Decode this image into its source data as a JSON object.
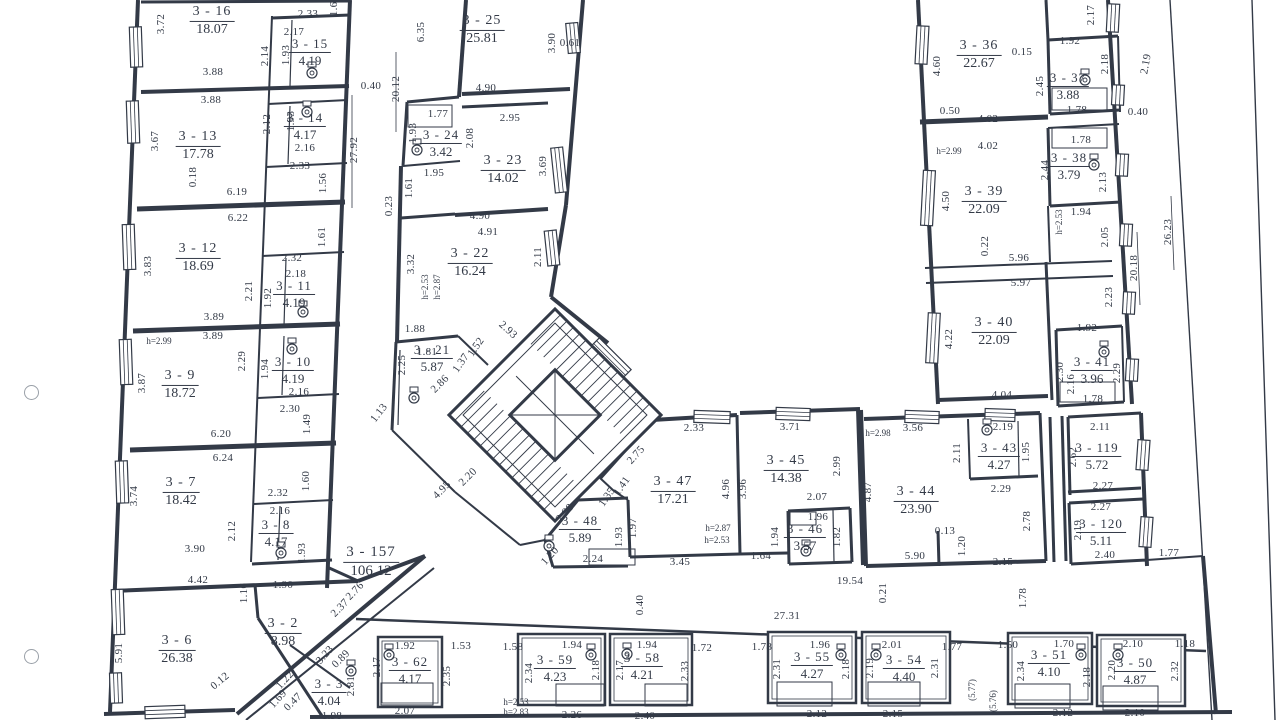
{
  "palette": {
    "ink": "#333a47",
    "paper": "#ffffff"
  },
  "drawing": {
    "type": "floor-plan",
    "rooms": [
      [
        "3 - 16",
        "18.07",
        212,
        21,
        14
      ],
      [
        "3 - 15",
        "4.19",
        310,
        52,
        13
      ],
      [
        "3 - 13",
        "17.78",
        198,
        146,
        14
      ],
      [
        "3 - 14",
        "4.17",
        305,
        126,
        13
      ],
      [
        "3 - 12",
        "18.69",
        198,
        258,
        14
      ],
      [
        "3 - 11",
        "4.19",
        294,
        294,
        13
      ],
      [
        "3 - 9",
        "18.72",
        180,
        385,
        14
      ],
      [
        "3 - 10",
        "4.19",
        293,
        370,
        13
      ],
      [
        "3 - 7",
        "18.42",
        181,
        492,
        14
      ],
      [
        "3 - 8",
        "4.17",
        276,
        533,
        13
      ],
      [
        "3 - 6",
        "26.38",
        177,
        650,
        14
      ],
      [
        "3 - 2",
        "8.98",
        283,
        633,
        14
      ],
      [
        "3 - 3",
        "4.04",
        329,
        692,
        13
      ],
      [
        "3 - 157",
        "106.12",
        371,
        562,
        15
      ],
      [
        "3 - 25",
        "25.81",
        482,
        30,
        14
      ],
      [
        "3 - 24",
        "3.42",
        441,
        143,
        13
      ],
      [
        "3 - 23",
        "14.02",
        503,
        170,
        14
      ],
      [
        "3 - 22",
        "16.24",
        470,
        263,
        14
      ],
      [
        "3 - 21",
        "5.87",
        432,
        358,
        13
      ],
      [
        "3 - 36",
        "22.67",
        979,
        55,
        14
      ],
      [
        "3 - 37",
        "3.88",
        1068,
        86,
        13
      ],
      [
        "3 - 38",
        "3.79",
        1069,
        166,
        13
      ],
      [
        "3 - 39",
        "22.09",
        984,
        201,
        14
      ],
      [
        "3 - 40",
        "22.09",
        994,
        332,
        14
      ],
      [
        "3 - 41",
        "3.96",
        1092,
        370,
        13
      ],
      [
        "3 - 47",
        "17.21",
        673,
        491,
        14
      ],
      [
        "3 - 45",
        "14.38",
        786,
        470,
        14
      ],
      [
        "3 - 48",
        "5.89",
        580,
        529,
        13
      ],
      [
        "3 - 46",
        "3.57",
        805,
        537,
        13
      ],
      [
        "3 - 44",
        "23.90",
        916,
        501,
        14
      ],
      [
        "3 - 43",
        "4.27",
        999,
        456,
        13
      ],
      [
        "3 - 119",
        "5.72",
        1097,
        456,
        13
      ],
      [
        "3 - 120",
        "5.11",
        1101,
        532,
        13
      ],
      [
        "3 - 62",
        "4.17",
        410,
        670,
        13
      ],
      [
        "3 - 59",
        "4.23",
        555,
        668,
        13
      ],
      [
        "3 - 58",
        "4.21",
        642,
        666,
        13
      ],
      [
        "3 - 55",
        "4.27",
        812,
        665,
        13
      ],
      [
        "3 - 54",
        "4.40",
        904,
        668,
        13
      ],
      [
        "3 - 51",
        "4.10",
        1049,
        663,
        13
      ],
      [
        "3 - 50",
        "4.87",
        1135,
        671,
        13
      ]
    ],
    "dims": [
      [
        "3.72",
        161,
        24,
        -90
      ],
      [
        "1.61",
        334,
        6,
        -90
      ],
      [
        "2.33",
        308,
        14,
        0
      ],
      [
        "2.17",
        294,
        32,
        0
      ],
      [
        "2.14",
        265,
        56,
        -90
      ],
      [
        "1.93",
        286,
        55,
        -90
      ],
      [
        "3.88",
        213,
        72,
        0
      ],
      [
        "3.88",
        211,
        100,
        0
      ],
      [
        "1.93",
        291,
        121,
        -90
      ],
      [
        "2.12",
        267,
        124,
        -90
      ],
      [
        "3.67",
        155,
        141,
        -90
      ],
      [
        "2.16",
        305,
        148,
        0
      ],
      [
        "2.33",
        300,
        166,
        0
      ],
      [
        "1.56",
        323,
        183,
        -90
      ],
      [
        "0.18",
        193,
        177,
        -90
      ],
      [
        "6.19",
        237,
        192,
        0
      ],
      [
        "0.40",
        371,
        86,
        0
      ],
      [
        "27.92",
        354,
        150,
        -90
      ],
      [
        "20.12",
        396,
        89,
        -90
      ],
      [
        "6.35",
        421,
        32,
        -90
      ],
      [
        "4.90",
        486,
        88,
        0
      ],
      [
        "3.90",
        552,
        43,
        -90
      ],
      [
        "0.61",
        570,
        43,
        0
      ],
      [
        "1.77",
        438,
        114,
        0
      ],
      [
        "1.93",
        413,
        133,
        -90
      ],
      [
        "2.08",
        470,
        138,
        -90
      ],
      [
        "2.95",
        510,
        118,
        0
      ],
      [
        "3.69",
        543,
        166,
        -90
      ],
      [
        "1.95",
        434,
        173,
        0
      ],
      [
        "1.61",
        409,
        188,
        -90
      ],
      [
        "0.23",
        389,
        206,
        -90
      ],
      [
        "6.22",
        238,
        218,
        0
      ],
      [
        "1.61",
        322,
        237,
        -90
      ],
      [
        "3.83",
        148,
        266,
        -90
      ],
      [
        "2.32",
        292,
        258,
        0
      ],
      [
        "2.18",
        296,
        274,
        0
      ],
      [
        "2.21",
        249,
        291,
        -90
      ],
      [
        "1.92",
        268,
        298,
        -90
      ],
      [
        "3.89",
        214,
        317,
        0
      ],
      [
        "3.89",
        213,
        336,
        0
      ],
      [
        "h=2.99",
        159,
        341,
        0
      ],
      [
        "2.29",
        242,
        361,
        -90
      ],
      [
        "1.94",
        265,
        369,
        -90
      ],
      [
        "3.87",
        142,
        383,
        -90
      ],
      [
        "2.16",
        299,
        392,
        0
      ],
      [
        "2.30",
        290,
        409,
        0
      ],
      [
        "1.49",
        307,
        424,
        -90
      ],
      [
        "6.20",
        221,
        434,
        0
      ],
      [
        "6.24",
        223,
        458,
        0
      ],
      [
        "3.74",
        134,
        496,
        -90
      ],
      [
        "1.60",
        306,
        481,
        -90
      ],
      [
        "2.32",
        278,
        493,
        0
      ],
      [
        "2.16",
        280,
        511,
        0
      ],
      [
        "2.12",
        232,
        531,
        -90
      ],
      [
        "3.90",
        195,
        549,
        0
      ],
      [
        "1.93",
        302,
        553,
        -90
      ],
      [
        "4.42",
        198,
        580,
        0
      ],
      [
        "1.90",
        283,
        585,
        0
      ],
      [
        "1.16",
        244,
        593,
        -90
      ],
      [
        "5.91",
        119,
        653,
        -90
      ],
      [
        "2.76",
        355,
        591,
        -46
      ],
      [
        "2.37",
        340,
        608,
        -46
      ],
      [
        "0.12",
        220,
        681,
        -40
      ],
      [
        "3.23",
        325,
        655,
        -48
      ],
      [
        "1.22",
        285,
        680,
        -48
      ],
      [
        "1.69",
        278,
        699,
        -48
      ],
      [
        "0.89",
        341,
        659,
        -45
      ],
      [
        "0.47",
        293,
        702,
        -45
      ],
      [
        "2.81",
        351,
        686,
        -90
      ],
      [
        "1.98",
        332,
        716,
        0
      ],
      [
        "4.90",
        480,
        216,
        0
      ],
      [
        "4.91",
        488,
        232,
        0
      ],
      [
        "3.32",
        411,
        264,
        -90
      ],
      [
        "2.11",
        538,
        257,
        -90
      ],
      [
        "h=2.53",
        425,
        287,
        -90
      ],
      [
        "h=2.87",
        437,
        287,
        -90
      ],
      [
        "1.88",
        415,
        329,
        0
      ],
      [
        "1.81",
        427,
        352,
        0
      ],
      [
        "2.93",
        508,
        330,
        42
      ],
      [
        "1.52",
        476,
        347,
        -55
      ],
      [
        "1.37",
        461,
        363,
        -55
      ],
      [
        "2.25",
        402,
        365,
        -90
      ],
      [
        "2.86",
        440,
        384,
        -45
      ],
      [
        "1.13",
        379,
        413,
        -52
      ],
      [
        "2.20",
        468,
        477,
        -45
      ],
      [
        "4.95",
        442,
        490,
        -45
      ],
      [
        "2.33",
        694,
        428,
        0
      ],
      [
        "2.75",
        636,
        455,
        -48
      ],
      [
        "1.41",
        622,
        486,
        -55
      ],
      [
        "1.35",
        607,
        497,
        -55
      ],
      [
        "3.71",
        790,
        427,
        0
      ],
      [
        "2.99",
        837,
        466,
        -90
      ],
      [
        "4.96",
        726,
        489,
        -90
      ],
      [
        "3.96",
        743,
        489,
        -90
      ],
      [
        "2.07",
        817,
        497,
        0
      ],
      [
        "h=2.87",
        718,
        528,
        0
      ],
      [
        "h=2.53",
        717,
        540,
        0
      ],
      [
        "1.96",
        818,
        517,
        0
      ],
      [
        "1.94",
        775,
        537,
        -90
      ],
      [
        "1.82",
        837,
        537,
        -90
      ],
      [
        "1.64",
        761,
        556,
        0
      ],
      [
        "3.45",
        680,
        562,
        0
      ],
      [
        "1.97",
        633,
        528,
        -90
      ],
      [
        "1.93",
        619,
        537,
        -90
      ],
      [
        "2.24",
        593,
        559,
        0
      ],
      [
        "1.20",
        550,
        556,
        -48
      ],
      [
        "2.98",
        565,
        513,
        -48
      ],
      [
        "19.54",
        850,
        581,
        0
      ],
      [
        "0.21",
        883,
        593,
        -90
      ],
      [
        "0.40",
        640,
        605,
        -90
      ],
      [
        "27.31",
        787,
        616,
        0
      ],
      [
        "4.60",
        937,
        66,
        -90
      ],
      [
        "0.15",
        1022,
        52,
        0
      ],
      [
        "1.92",
        1070,
        41,
        0
      ],
      [
        "2.17",
        1091,
        15,
        -90
      ],
      [
        "2.45",
        1040,
        86,
        -90
      ],
      [
        "2.18",
        1105,
        64,
        -90
      ],
      [
        "2.19",
        1146,
        64,
        -80
      ],
      [
        "0.50",
        950,
        111,
        0
      ],
      [
        "4.02",
        988,
        119,
        0
      ],
      [
        "4.02",
        988,
        146,
        0
      ],
      [
        "h=2.99",
        949,
        151,
        0
      ],
      [
        "1.78",
        1077,
        110,
        0
      ],
      [
        "1.78",
        1081,
        140,
        0
      ],
      [
        "2.44",
        1045,
        170,
        -90
      ],
      [
        "2.13",
        1103,
        182,
        -90
      ],
      [
        "1.94",
        1081,
        212,
        0
      ],
      [
        "h=2.53",
        1059,
        222,
        -90
      ],
      [
        "2.05",
        1105,
        237,
        -90
      ],
      [
        "4.50",
        946,
        201,
        -90
      ],
      [
        "0.22",
        985,
        246,
        -90
      ],
      [
        "5.96",
        1019,
        258,
        0
      ],
      [
        "5.97",
        1021,
        283,
        0
      ],
      [
        "2.23",
        1109,
        297,
        -90
      ],
      [
        "20.18",
        1134,
        268,
        -90
      ],
      [
        "26.23",
        1168,
        232,
        -90
      ],
      [
        "0.40",
        1138,
        112,
        0
      ],
      [
        "4.22",
        949,
        339,
        -90
      ],
      [
        "1.92",
        1087,
        328,
        0
      ],
      [
        "2.30",
        1060,
        372,
        -90
      ],
      [
        "2.16",
        1071,
        384,
        -90
      ],
      [
        "2.29",
        1117,
        373,
        -90
      ],
      [
        "1.78",
        1093,
        399,
        0
      ],
      [
        "4.04",
        1002,
        395,
        0
      ],
      [
        "3.56",
        913,
        428,
        0
      ],
      [
        "h=2.98",
        878,
        433,
        0
      ],
      [
        "2.11",
        957,
        453,
        -90
      ],
      [
        "2.19",
        1003,
        427,
        0
      ],
      [
        "1.95",
        1026,
        452,
        -90
      ],
      [
        "4.87",
        868,
        492,
        -90
      ],
      [
        "2.29",
        1001,
        489,
        0
      ],
      [
        "2.78",
        1027,
        521,
        -90
      ],
      [
        "0.13",
        945,
        531,
        0
      ],
      [
        "1.20",
        962,
        546,
        -90
      ],
      [
        "5.90",
        915,
        556,
        0
      ],
      [
        "2.15",
        1003,
        562,
        0
      ],
      [
        "2.62",
        1073,
        457,
        -90
      ],
      [
        "2.11",
        1100,
        427,
        0
      ],
      [
        "2.27",
        1103,
        486,
        0
      ],
      [
        "2.27",
        1101,
        507,
        0
      ],
      [
        "2.19",
        1078,
        530,
        -90
      ],
      [
        "2.40",
        1105,
        555,
        0
      ],
      [
        "1.77",
        1169,
        553,
        0
      ],
      [
        "1.78",
        1023,
        598,
        -90
      ],
      [
        "1.92",
        405,
        646,
        0
      ],
      [
        "2.17",
        377,
        667,
        -90
      ],
      [
        "2.35",
        447,
        676,
        -90
      ],
      [
        "1.53",
        461,
        646,
        0
      ],
      [
        "1.58",
        513,
        647,
        0
      ],
      [
        "1.94",
        572,
        645,
        0
      ],
      [
        "2.34",
        529,
        673,
        -90
      ],
      [
        "2.18",
        596,
        670,
        -90
      ],
      [
        "1.94",
        647,
        645,
        0
      ],
      [
        "2.17",
        620,
        670,
        -90
      ],
      [
        "2.33",
        685,
        671,
        -90
      ],
      [
        "2.07",
        405,
        711,
        0
      ],
      [
        "h=2.53",
        516,
        702,
        0
      ],
      [
        "h=2.83",
        516,
        712,
        0
      ],
      [
        "2.26",
        572,
        715,
        0
      ],
      [
        "2.40",
        645,
        716,
        0
      ],
      [
        "1.72",
        702,
        648,
        0
      ],
      [
        "1.78",
        762,
        647,
        0
      ],
      [
        "1.96",
        820,
        645,
        0
      ],
      [
        "2.31",
        777,
        669,
        -90
      ],
      [
        "2.18",
        846,
        669,
        -90
      ],
      [
        "2.19",
        870,
        668,
        -90
      ],
      [
        "2.01",
        892,
        645,
        0
      ],
      [
        "2.31",
        935,
        668,
        -90
      ],
      [
        "1.77",
        952,
        647,
        0
      ],
      [
        "(5.77)",
        972,
        690,
        -90
      ],
      [
        "(5.76)",
        993,
        701,
        -90
      ],
      [
        "2.12",
        817,
        714,
        0
      ],
      [
        "2.15",
        893,
        714,
        0
      ],
      [
        "1.50",
        1008,
        645,
        0
      ],
      [
        "1.70",
        1064,
        644,
        0
      ],
      [
        "2.34",
        1021,
        671,
        -90
      ],
      [
        "2.18",
        1087,
        677,
        -90
      ],
      [
        "2.10",
        1133,
        644,
        0
      ],
      [
        "2.20",
        1112,
        670,
        -90
      ],
      [
        "2.32",
        1175,
        671,
        -90
      ],
      [
        "1.18",
        1185,
        644,
        0
      ],
      [
        "2.12",
        1063,
        713,
        0
      ],
      [
        "2.10",
        1135,
        713,
        0
      ]
    ]
  }
}
